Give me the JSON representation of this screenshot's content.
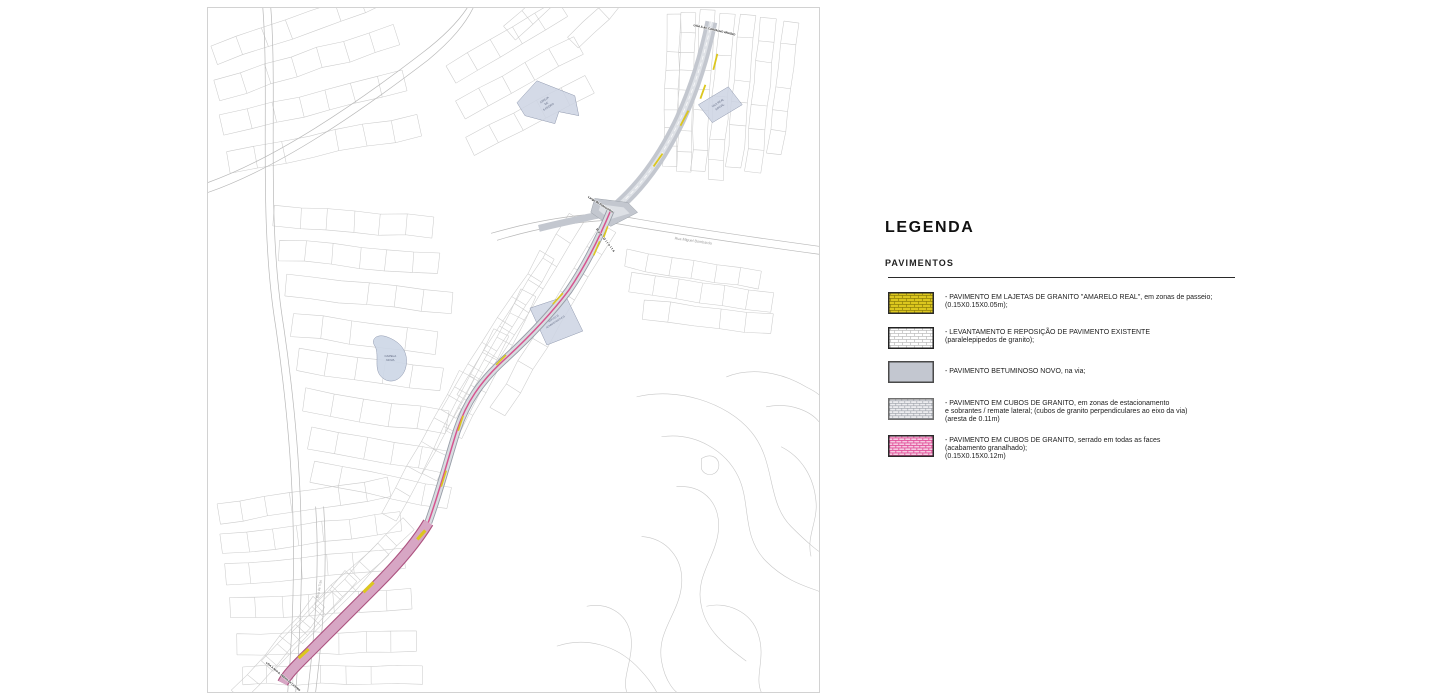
{
  "legend": {
    "title": "LEGENDA",
    "section": "PAVIMENTOS",
    "items": [
      {
        "name": "lajetas-granito-amarelo",
        "color": "#dcc71e",
        "line1": "- PAVIMENTO EM LAJETAS DE GRANITO \"AMARELO REAL\", em zonas de passeio;",
        "line2": "(0.15X0.15X0.05m);"
      },
      {
        "name": "reposicao-pavimento-existente",
        "color": "#ffffff",
        "line1": "- LEVANTAMENTO E REPOSIÇÃO DE PAVIMENTO EXISTENTE",
        "line2": "(paralelepipedos de granito);"
      },
      {
        "name": "betuminoso-novo",
        "color": "#c3c7d0",
        "line1": "- PAVIMENTO BETUMINOSO NOVO, na via;"
      },
      {
        "name": "cubos-granito-estacionamento",
        "color": "#ececef",
        "line1": "- PAVIMENTO EM CUBOS DE GRANITO, em zonas de estacionamento",
        "line2": "e sobrantes / remate lateral; (cubos de granito perpendiculares ao eixo da via)",
        "line3": "(aresta de 0.11m)"
      },
      {
        "name": "cubos-granito-serrado",
        "color": "#e2519b",
        "line1": "- PAVIMENTO EM CUBOS DE GRANITO, serrado em todas as faces",
        "line2": "(acabamento granalhado);",
        "line3": "(0.15X0.15X0.12m)"
      }
    ]
  },
  "map": {
    "buildings": {
      "igreja_l1": "IGREJA",
      "igreja_l2": "DE",
      "igreja_l3": "S.PEDRO",
      "vila_real_l1": "VILA REAL",
      "vila_real_l2": "SOCIAL",
      "capela_l1": "CAPELA",
      "capela_l2": "NOVA",
      "servicos_l1": "SERVIÇOS",
      "servicos_l2": "ADMINISTRATIVOS"
    },
    "streets": {
      "rua_miguel_bombarda": "Rua Miguel Bombarda",
      "largo_pelourinho": "Largo do Pelourinho",
      "rua_direita": "Rua Direita",
      "rua_de_tras": "Rua de Trás"
    },
    "connectors": {
      "top": "LIGA À AV. CARVALHO ARAÚJO",
      "bottom": "LIGA À RUA D. PEDRO DE CASTRO"
    }
  }
}
